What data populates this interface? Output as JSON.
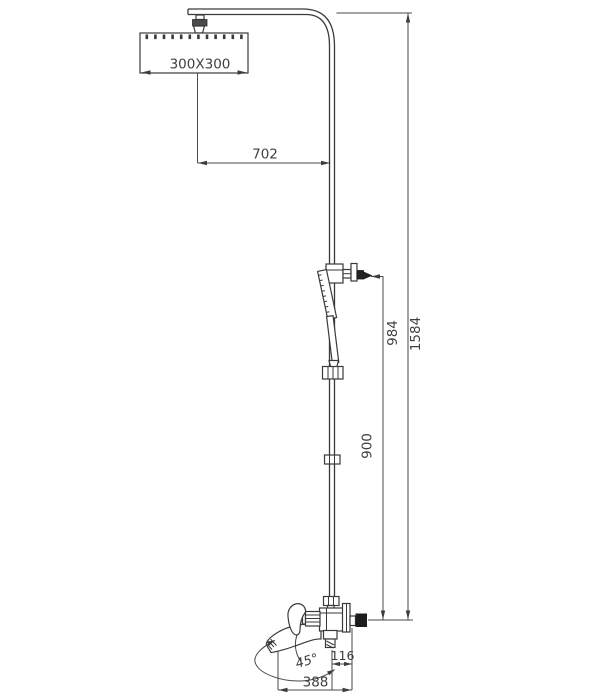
{
  "drawing": {
    "type": "technical dimension drawing",
    "subject": "shower column with overhead rain shower, hand shower and swivel bath spout",
    "labels": {
      "head_size": "300X300",
      "head_to_riser_offset": "702",
      "hand_shower_outlet_height": "984",
      "total_height": "1584",
      "riser_to_outlet_height": "900",
      "spout_swivel_angle": "45°",
      "spout_drop": "116",
      "spout_reach": "388"
    },
    "colors": {
      "line": "#3a3a3a",
      "dimension_line": "#4a4a4a",
      "solid_black": "#1d1d1d",
      "background": "#ffffff"
    }
  }
}
